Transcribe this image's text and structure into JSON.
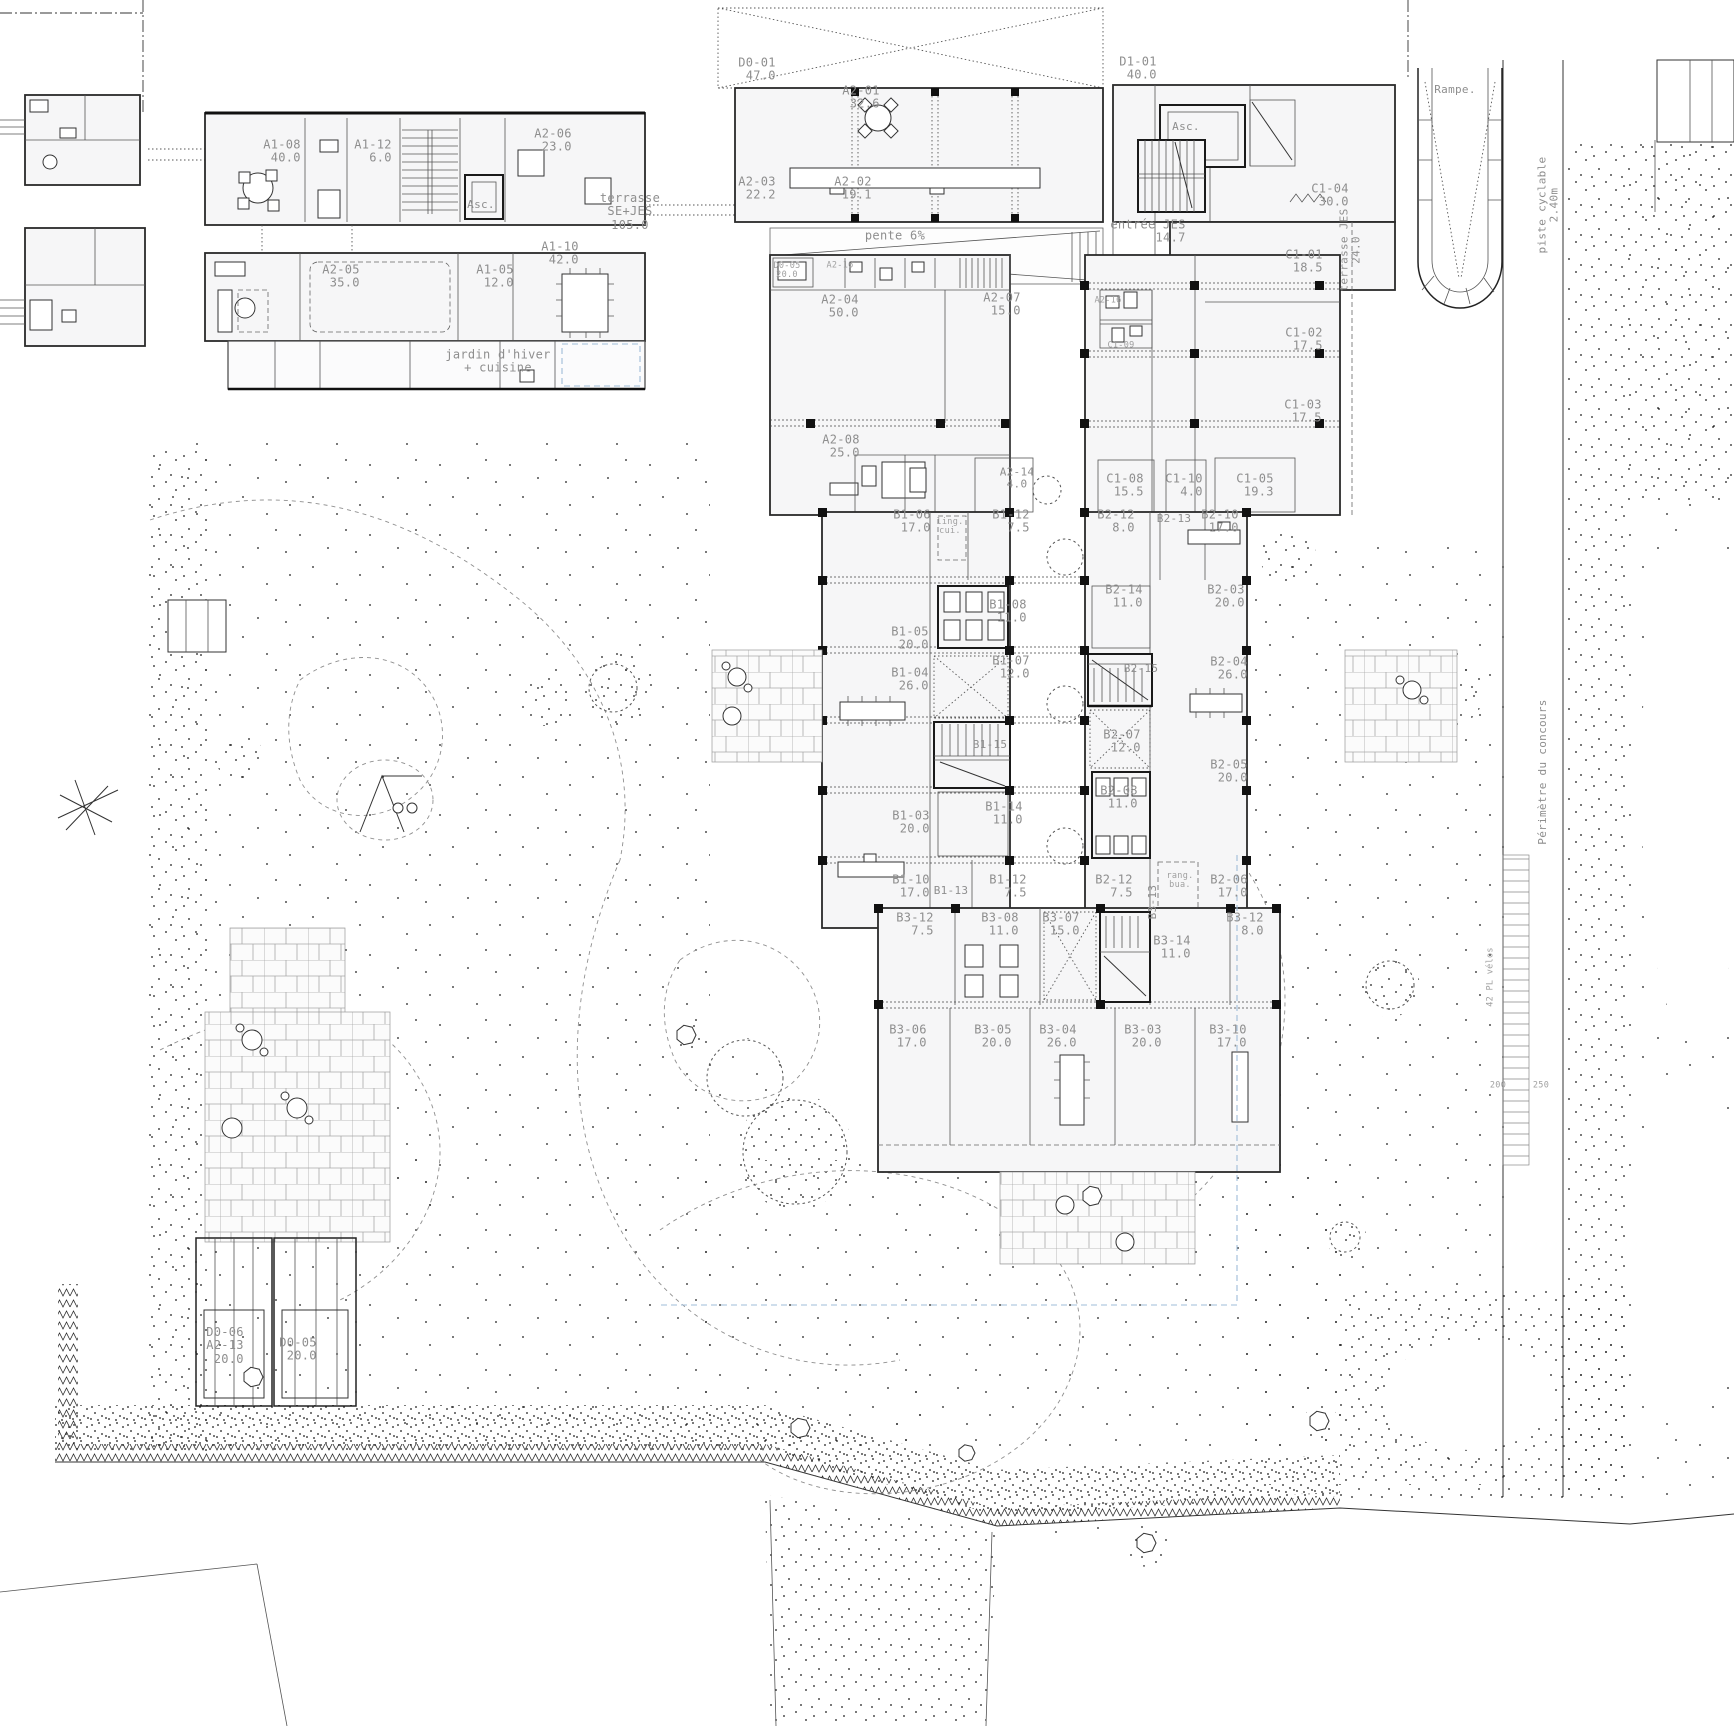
{
  "plan": {
    "colors": {
      "background": "#ffffff",
      "wall_line": "#222222",
      "label_gray": "#8e8e8e",
      "garden_dot": "#1a1a1a",
      "guide_blue": "#9fbcd8"
    },
    "labels": [
      {
        "lines": [
          "A1-08",
          "40.0"
        ],
        "x": 282,
        "y": 152
      },
      {
        "lines": [
          "A1-12",
          "6.0"
        ],
        "x": 373,
        "y": 152
      },
      {
        "lines": [
          "A2-06",
          "23.0"
        ],
        "x": 553,
        "y": 141
      },
      {
        "lines": [
          "Asc."
        ],
        "x": 481,
        "y": 205,
        "cls": "small"
      },
      {
        "lines": [
          "A2-05",
          "35.0"
        ],
        "x": 341,
        "y": 277
      },
      {
        "lines": [
          "A1-05",
          "12.0"
        ],
        "x": 495,
        "y": 277
      },
      {
        "lines": [
          "A1-10",
          "42.0"
        ],
        "x": 560,
        "y": 254
      },
      {
        "lines": [
          "jardin d'hiver",
          "+ cuisine"
        ],
        "x": 498,
        "y": 362,
        "cls": "note"
      },
      {
        "lines": [
          "terrasse",
          "SE+JES",
          "105.0"
        ],
        "x": 630,
        "y": 212,
        "cls": "note"
      },
      {
        "lines": [
          "D0-01",
          "47.0"
        ],
        "x": 757,
        "y": 70
      },
      {
        "lines": [
          "A2-01",
          "32.6"
        ],
        "x": 861,
        "y": 98
      },
      {
        "lines": [
          "A2-03",
          "22.2"
        ],
        "x": 757,
        "y": 189
      },
      {
        "lines": [
          "A2-02",
          "19.1"
        ],
        "x": 853,
        "y": 189
      },
      {
        "lines": [
          "pente 6%"
        ],
        "x": 895,
        "y": 236,
        "cls": "note"
      },
      {
        "lines": [
          "D1-01",
          "40.0"
        ],
        "x": 1138,
        "y": 69
      },
      {
        "lines": [
          "Asc."
        ],
        "x": 1186,
        "y": 127,
        "cls": "small"
      },
      {
        "lines": [
          "C1-04",
          "30.0"
        ],
        "x": 1330,
        "y": 196
      },
      {
        "lines": [
          "entrée JES",
          "14.7"
        ],
        "x": 1148,
        "y": 232
      },
      {
        "lines": [
          "terrasse JES",
          "24.0"
        ],
        "x": 1351,
        "y": 250,
        "rot": -90,
        "cls": "small"
      },
      {
        "lines": [
          "D0-05",
          "20.0"
        ],
        "x": 787,
        "y": 271,
        "cls": "tiny"
      },
      {
        "lines": [
          "A2-16"
        ],
        "x": 840,
        "y": 266,
        "cls": "tiny"
      },
      {
        "lines": [
          "A2-04",
          "50.0"
        ],
        "x": 840,
        "y": 307
      },
      {
        "lines": [
          "A2-07",
          "15.0"
        ],
        "x": 1002,
        "y": 305
      },
      {
        "lines": [
          "A2-16"
        ],
        "x": 1108,
        "y": 301,
        "cls": "tiny"
      },
      {
        "lines": [
          "C1-09"
        ],
        "x": 1121,
        "y": 346,
        "cls": "tiny"
      },
      {
        "lines": [
          "C1-01",
          "18.5"
        ],
        "x": 1304,
        "y": 262
      },
      {
        "lines": [
          "C1-02",
          "17.5"
        ],
        "x": 1304,
        "y": 340
      },
      {
        "lines": [
          "C1-03",
          "17.5"
        ],
        "x": 1303,
        "y": 412
      },
      {
        "lines": [
          "A2-08",
          "25.0"
        ],
        "x": 841,
        "y": 447
      },
      {
        "lines": [
          "A2-14",
          "4.0"
        ],
        "x": 1017,
        "y": 479,
        "cls": "small"
      },
      {
        "lines": [
          "C1-08",
          "15.5"
        ],
        "x": 1125,
        "y": 486
      },
      {
        "lines": [
          "C1-10",
          "4.0"
        ],
        "x": 1184,
        "y": 486
      },
      {
        "lines": [
          "C1-05",
          "19.3"
        ],
        "x": 1255,
        "y": 486
      },
      {
        "lines": [
          "B1-06",
          "17.0"
        ],
        "x": 912,
        "y": 522
      },
      {
        "lines": [
          "ling.",
          "cui."
        ],
        "x": 950,
        "y": 527,
        "cls": "tiny"
      },
      {
        "lines": [
          "B1-12",
          "7.5"
        ],
        "x": 1011,
        "y": 522
      },
      {
        "lines": [
          "B2-12",
          "8.0"
        ],
        "x": 1116,
        "y": 522
      },
      {
        "lines": [
          "B2-13"
        ],
        "x": 1174,
        "y": 519,
        "cls": "small"
      },
      {
        "lines": [
          "B2-10",
          "17.0"
        ],
        "x": 1220,
        "y": 522
      },
      {
        "lines": [
          "B1-05",
          "20.0"
        ],
        "x": 910,
        "y": 639
      },
      {
        "lines": [
          "B1-08",
          "11.0"
        ],
        "x": 1008,
        "y": 612
      },
      {
        "lines": [
          "B2-14",
          "11.0"
        ],
        "x": 1124,
        "y": 597
      },
      {
        "lines": [
          "B2-03",
          "20.0"
        ],
        "x": 1226,
        "y": 597
      },
      {
        "lines": [
          "B1-04",
          "26.0"
        ],
        "x": 910,
        "y": 680
      },
      {
        "lines": [
          "B1-07",
          "12.0"
        ],
        "x": 1011,
        "y": 668
      },
      {
        "lines": [
          "B2-15"
        ],
        "x": 1141,
        "y": 669,
        "cls": "small"
      },
      {
        "lines": [
          "B2-04",
          "26.0"
        ],
        "x": 1229,
        "y": 669
      },
      {
        "lines": [
          "B1-15"
        ],
        "x": 990,
        "y": 745,
        "cls": "small"
      },
      {
        "lines": [
          "B2-07",
          "12.0"
        ],
        "x": 1122,
        "y": 742
      },
      {
        "lines": [
          "B2-05",
          "20.0"
        ],
        "x": 1229,
        "y": 772
      },
      {
        "lines": [
          "B1-03",
          "20.0"
        ],
        "x": 911,
        "y": 823
      },
      {
        "lines": [
          "B1-14",
          "11.0"
        ],
        "x": 1004,
        "y": 814
      },
      {
        "lines": [
          "B2-08",
          "11.0"
        ],
        "x": 1119,
        "y": 798
      },
      {
        "lines": [
          "B1-10",
          "17.0"
        ],
        "x": 911,
        "y": 887
      },
      {
        "lines": [
          "B1-13"
        ],
        "x": 951,
        "y": 891,
        "cls": "small"
      },
      {
        "lines": [
          "B1-12",
          "7.5"
        ],
        "x": 1008,
        "y": 887
      },
      {
        "lines": [
          "B2-12",
          "7.5"
        ],
        "x": 1114,
        "y": 887
      },
      {
        "lines": [
          "rang.",
          "bua."
        ],
        "x": 1180,
        "y": 881,
        "cls": "tiny"
      },
      {
        "lines": [
          "B2-06",
          "17.0"
        ],
        "x": 1229,
        "y": 887
      },
      {
        "lines": [
          "B3-13"
        ],
        "x": 1153,
        "y": 902,
        "rot": -90,
        "cls": "small"
      },
      {
        "lines": [
          "B3-12",
          "7.5"
        ],
        "x": 915,
        "y": 925
      },
      {
        "lines": [
          "B3-08",
          "11.0"
        ],
        "x": 1000,
        "y": 925
      },
      {
        "lines": [
          "B3-07",
          "15.0"
        ],
        "x": 1061,
        "y": 925
      },
      {
        "lines": [
          "B3-14",
          "11.0"
        ],
        "x": 1172,
        "y": 948
      },
      {
        "lines": [
          "B3-12",
          "8.0"
        ],
        "x": 1245,
        "y": 925
      },
      {
        "lines": [
          "B3-06",
          "17.0"
        ],
        "x": 908,
        "y": 1037
      },
      {
        "lines": [
          "B3-05",
          "20.0"
        ],
        "x": 993,
        "y": 1037
      },
      {
        "lines": [
          "B3-04",
          "26.0"
        ],
        "x": 1058,
        "y": 1037
      },
      {
        "lines": [
          "B3-03",
          "20.0"
        ],
        "x": 1143,
        "y": 1037
      },
      {
        "lines": [
          "B3-10",
          "17.0"
        ],
        "x": 1228,
        "y": 1037
      },
      {
        "lines": [
          "D0-06",
          "A2-13",
          "20.0"
        ],
        "x": 225,
        "y": 1346
      },
      {
        "lines": [
          "D0-05",
          "20.0"
        ],
        "x": 298,
        "y": 1350
      },
      {
        "lines": [
          "Rampe."
        ],
        "x": 1455,
        "y": 90,
        "cls": "small"
      },
      {
        "lines": [
          "piste cyclable",
          "2.40m"
        ],
        "x": 1549,
        "y": 205,
        "rot": -90,
        "cls": "small"
      },
      {
        "lines": [
          "Périmètre du concours"
        ],
        "x": 1543,
        "y": 772,
        "rot": -90,
        "cls": "small"
      },
      {
        "lines": [
          "42 PL vélos"
        ],
        "x": 1491,
        "y": 977,
        "rot": -90,
        "cls": "tiny"
      },
      {
        "lines": [
          "200"
        ],
        "x": 1498,
        "y": 1086,
        "cls": "tiny"
      },
      {
        "lines": [
          "250"
        ],
        "x": 1541,
        "y": 1086,
        "cls": "tiny"
      }
    ]
  }
}
